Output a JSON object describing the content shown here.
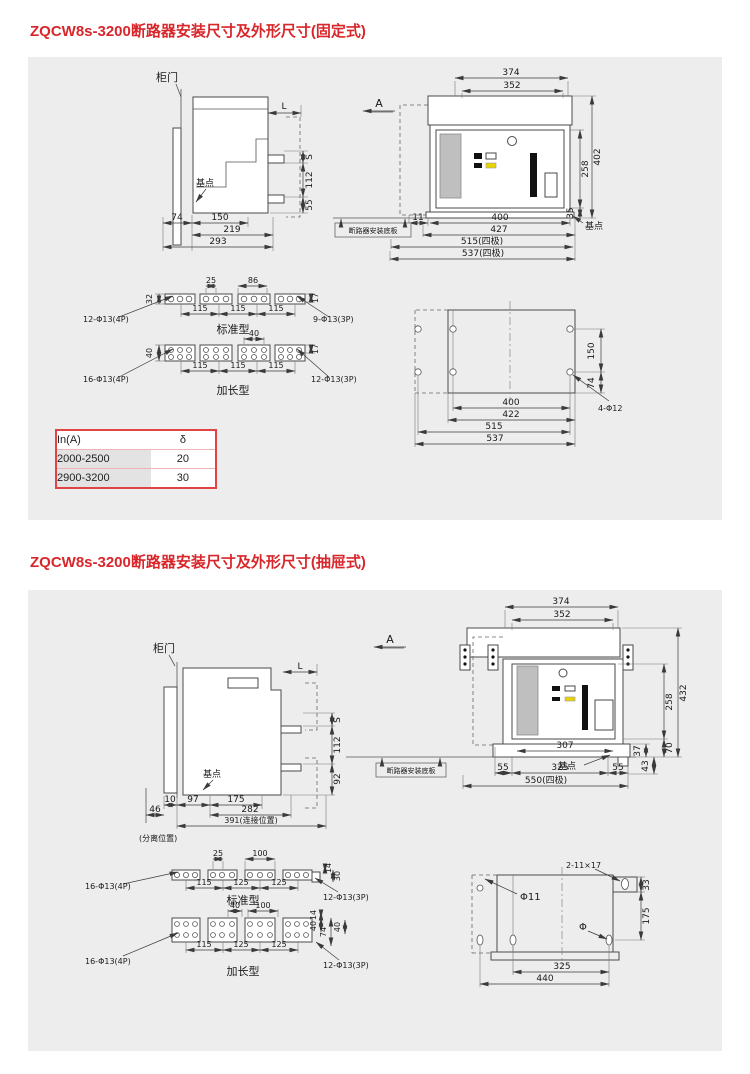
{
  "page": {
    "bg": "#ffffff",
    "panel_bg": "#ededed",
    "accent": "#d9262b"
  },
  "s1": {
    "title": "ZQCW8s-3200断路器安装尺寸及外形尺寸(固定式)",
    "side": {
      "door": "柜门",
      "base": "基点",
      "L": "L",
      "S": "S",
      "d112": "112",
      "d55": "55",
      "d74": "74",
      "d150": "150",
      "d219": "219",
      "d293": "293"
    },
    "front": {
      "a": "A",
      "plate": "断路器安装底板",
      "base": "基点",
      "d374": "374",
      "d352": "352",
      "d402": "402",
      "d258": "258",
      "d35": "35",
      "d11": "11",
      "d400": "400",
      "d427": "427",
      "d515": "515(四极)",
      "d537": "537(四极)"
    },
    "bus_std": {
      "name": "标准型",
      "left": "12-Φ13(4P)",
      "right": "9-Φ13(3P)",
      "t1": "25",
      "t2": "86",
      "hl": "32",
      "hr": "17",
      "b1": "115",
      "b2": "115",
      "b3": "115"
    },
    "bus_ext": {
      "name": "加长型",
      "left": "16-Φ13(4P)",
      "right": "12-Φ13(3P)",
      "t1": "40",
      "hl": "40",
      "hr": "17",
      "b1": "115",
      "b2": "115",
      "b3": "115"
    },
    "table": {
      "h1": "In(A)",
      "h2": "δ",
      "rows": [
        [
          "2000-2500",
          "20"
        ],
        [
          "2900-3200",
          "30"
        ]
      ]
    },
    "holes": {
      "label": "4-Φ12",
      "d150": "150",
      "d74": "74",
      "d400": "400",
      "d422": "422",
      "d515": "515",
      "d537": "537"
    }
  },
  "s2": {
    "title": "ZQCW8s-3200断路器安装尺寸及外形尺寸(抽屉式)",
    "side": {
      "door": "柜门",
      "base": "基点",
      "L": "L",
      "S": "S",
      "d112": "112",
      "d92": "92",
      "d10": "10",
      "d97": "97",
      "d175": "175",
      "d282": "282",
      "d391": "391(连接位置)",
      "d46": "46",
      "sep": "(分离位置)"
    },
    "front": {
      "a": "A",
      "plate": "断路器安装底板",
      "base": "基点",
      "d374": "374",
      "d352": "352",
      "d432": "432",
      "d258": "258",
      "d70": "70",
      "d37": "37",
      "d43": "43",
      "d307": "307",
      "d55a": "55",
      "d325": "325",
      "d55b": "55",
      "d550": "550(四极)"
    },
    "bus_std": {
      "name": "标准型",
      "left": "16-Φ13(4P)",
      "right": "12-Φ13(3P)",
      "t1": "25",
      "t2": "100",
      "hr1": "14",
      "hr2": "30",
      "b1": "115",
      "b2": "125",
      "b3": "125"
    },
    "bus_ext": {
      "name": "加长型",
      "left": "16-Φ13(4P)",
      "right": "12-Φ13(3P)",
      "t1": "40",
      "t2": "100",
      "hr1": "14",
      "hr2": "40",
      "hr3": "74",
      "hr4": "40",
      "b1": "115",
      "b2": "125",
      "b3": "125"
    },
    "holes": {
      "phi11": "Φ11",
      "slot": "2-11×17",
      "phi": "Φ",
      "d33": "33",
      "d175": "175",
      "d325": "325",
      "d440": "440"
    }
  }
}
